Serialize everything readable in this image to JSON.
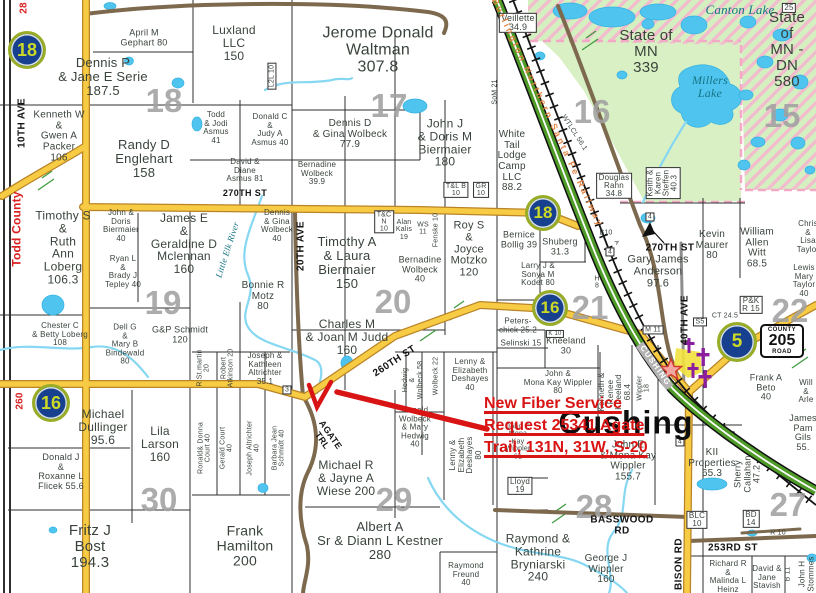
{
  "map": {
    "town_label": "Cushing",
    "county_road_sign": {
      "top": "COUNTY",
      "number": "205",
      "bottom": "ROAD",
      "x": 782,
      "y": 341
    },
    "annotation": {
      "color": "#d91414",
      "lines": [
        {
          "text": "New Fiber Service",
          "x": 484,
          "y": 395
        },
        {
          "text": "Request 25341 Agate",
          "x": 484,
          "y": 417
        },
        {
          "text": "Trail, 131N, 31W, S-20",
          "x": 484,
          "y": 439
        }
      ]
    },
    "highway_markers": [
      {
        "n": "18",
        "x": 27,
        "y": 50,
        "d": 32
      },
      {
        "n": "18",
        "x": 543,
        "y": 213,
        "d": 30
      },
      {
        "n": "16",
        "x": 550,
        "y": 308,
        "d": 30
      },
      {
        "n": "16",
        "x": 51,
        "y": 403,
        "d": 32
      },
      {
        "n": "5",
        "x": 737,
        "y": 342,
        "d": 34
      }
    ],
    "section_numbers": [
      {
        "n": "18",
        "x": 164,
        "y": 101
      },
      {
        "n": "17",
        "x": 389,
        "y": 106
      },
      {
        "n": "16",
        "x": 592,
        "y": 112
      },
      {
        "n": "15",
        "x": 782,
        "y": 116
      },
      {
        "n": "19",
        "x": 163,
        "y": 303
      },
      {
        "n": "20",
        "x": 393,
        "y": 302
      },
      {
        "n": "21",
        "x": 590,
        "y": 308
      },
      {
        "n": "22",
        "x": 790,
        "y": 311
      },
      {
        "n": "30",
        "x": 159,
        "y": 500
      },
      {
        "n": "29",
        "x": 394,
        "y": 500
      },
      {
        "n": "28",
        "x": 594,
        "y": 507
      },
      {
        "n": "27",
        "x": 788,
        "y": 505
      }
    ],
    "colors": {
      "road_yellow": "#f7cb43",
      "road_edge": "#b98427",
      "road_brown": "#7d6a4e",
      "highway_green": "#4e9b28",
      "water_fill": "#4fc4ee",
      "state_land": "#d9f0c4",
      "hatch_pink": "#f2bccd",
      "marker_blue": "#17418e",
      "marker_text": "#cdd927",
      "annotation_red": "#d91414",
      "section_gray": "#a1a1a1",
      "cemetery_purple": "#8b1f9e"
    },
    "labels": [
      {
        "t": "April M\nGephart 80",
        "x": 144,
        "y": 38,
        "fs": 9
      },
      {
        "t": "Luxland\nLLC\n150",
        "x": 234,
        "y": 43,
        "fs": 12
      },
      {
        "t": "Jerome Donald\nWaltman\n307.8",
        "x": 378,
        "y": 50,
        "fs": 16
      },
      {
        "t": "Dennis P\n& Jane E Serie\n187.5",
        "x": 103,
        "y": 77,
        "fs": 13
      },
      {
        "t": "Kenneth W\n&\nGwen A\nPacker\n106",
        "x": 59,
        "y": 137,
        "fs": 10
      },
      {
        "t": "Randy D\nEnglehart\n158",
        "x": 144,
        "y": 159,
        "fs": 13
      },
      {
        "t": "Todd\n& Jodi\nAsmus\n41",
        "x": 216,
        "y": 128,
        "fs": 8
      },
      {
        "t": "Donald C\n&\nJudy A\nAsmus 40",
        "x": 270,
        "y": 130,
        "fs": 8
      },
      {
        "t": "David &\nDiane\nAsmus 81",
        "x": 245,
        "y": 171,
        "fs": 8
      },
      {
        "t": "Bernadine\nWolbeck\n39.9",
        "x": 317,
        "y": 174,
        "fs": 8
      },
      {
        "t": "Dennis D\n& Gina Wolbeck\n77.9",
        "x": 350,
        "y": 135,
        "fs": 10
      },
      {
        "t": "John J\n& Doris M\nBiermaier\n180",
        "x": 445,
        "y": 143,
        "fs": 12
      },
      {
        "t": "White\nTail\nLodge\nCamp\nLLC\n88.2",
        "x": 512,
        "y": 162,
        "fs": 10
      },
      {
        "t": "Veillette\n34.9",
        "x": 518,
        "y": 23,
        "fs": 9,
        "c": "boxed"
      },
      {
        "t": "State of\nMN\n339",
        "x": 646,
        "y": 52,
        "fs": 15
      },
      {
        "t": "State of\nMN - DN\n580",
        "x": 787,
        "y": 50,
        "fs": 15
      },
      {
        "t": "Douglas\nRahn\n34.8",
        "x": 614,
        "y": 186,
        "fs": 8,
        "c": "boxed"
      },
      {
        "t": "Keith &\nKaren\nSteffen\n40.3",
        "x": 663,
        "y": 183,
        "fs": 8,
        "r": -90,
        "c": "boxed"
      },
      {
        "t": "Timothy S\n&\nRuth\nAnn\nLoberg\n106.3",
        "x": 63,
        "y": 248,
        "fs": 12
      },
      {
        "t": "John &\nDoris\nBiermaier\n40",
        "x": 121,
        "y": 226,
        "fs": 8
      },
      {
        "t": "Ryan L\n&\nBrady J\nTepley 40",
        "x": 123,
        "y": 272,
        "fs": 8
      },
      {
        "t": "James E\n&\nGeraldine D\nMclennan\n160",
        "x": 184,
        "y": 244,
        "fs": 12
      },
      {
        "t": "Dennis\n& Gina\nWolbeck\n40",
        "x": 277,
        "y": 226,
        "fs": 8
      },
      {
        "t": "Bonnie R\nMotz\n80",
        "x": 263,
        "y": 297,
        "fs": 10
      },
      {
        "t": "Timothy A\n& Laura\nBiermaier\n150",
        "x": 347,
        "y": 263,
        "fs": 13
      },
      {
        "t": "T&C\nN\n10",
        "x": 384,
        "y": 222,
        "fs": 7,
        "c": "boxed"
      },
      {
        "t": "Alan\nKalis\n19",
        "x": 404,
        "y": 230,
        "fs": 7
      },
      {
        "t": "WS\n11",
        "x": 423,
        "y": 229,
        "fs": 7
      },
      {
        "t": "Fenske 10",
        "x": 436,
        "y": 230,
        "fs": 7,
        "r": -90
      },
      {
        "t": "Bernadine\nWolbeck\n40",
        "x": 420,
        "y": 270,
        "fs": 9
      },
      {
        "t": "Roy S\n&\nJoyce\nMotzko\n120",
        "x": 469,
        "y": 250,
        "fs": 11
      },
      {
        "t": "Bernice\nBollig 39",
        "x": 519,
        "y": 240,
        "fs": 9
      },
      {
        "t": "Shuberg\n31.3",
        "x": 560,
        "y": 247,
        "fs": 9
      },
      {
        "t": "Larry J &\nSonya M\nKodet 80",
        "x": 538,
        "y": 275,
        "fs": 8
      },
      {
        "t": "Chester C\n& Betty Loberg\n108",
        "x": 60,
        "y": 335,
        "fs": 8
      },
      {
        "t": "Dell G\n&\nMary B\nBindewald\n80",
        "x": 125,
        "y": 345,
        "fs": 8
      },
      {
        "t": "G&P Schmidt\n120",
        "x": 180,
        "y": 335,
        "fs": 9
      },
      {
        "t": "Charles M\n& Joan M Judd\n160",
        "x": 347,
        "y": 337,
        "fs": 12
      },
      {
        "t": "Peters-\nchick 25.2",
        "x": 518,
        "y": 326,
        "fs": 8
      },
      {
        "t": "Selinski 15",
        "x": 521,
        "y": 344,
        "fs": 8
      },
      {
        "t": "K 10",
        "x": 555,
        "y": 334,
        "fs": 6,
        "c": "boxed"
      },
      {
        "t": "Kneeland\n30",
        "x": 566,
        "y": 346,
        "fs": 9
      },
      {
        "t": "Kevin\nMaurer\n80",
        "x": 712,
        "y": 246,
        "fs": 10
      },
      {
        "t": "William\nAllen\nWitt\n68.5",
        "x": 757,
        "y": 249,
        "fs": 10
      },
      {
        "t": "Gary James\nAnderson\n97.6",
        "x": 658,
        "y": 272,
        "fs": 11
      },
      {
        "t": "Lewis\nMary\nTaylor\n40",
        "x": 804,
        "y": 281,
        "fs": 8
      },
      {
        "t": "Chris &\nLisa\nTaylor",
        "x": 808,
        "y": 237,
        "fs": 8
      },
      {
        "t": "P&K\nR 15",
        "x": 751,
        "y": 305,
        "fs": 8,
        "c": "boxed"
      },
      {
        "t": "CT 24.5",
        "x": 725,
        "y": 316,
        "fs": 7
      },
      {
        "t": "S5",
        "x": 700,
        "y": 322,
        "fs": 7,
        "c": "boxed"
      },
      {
        "t": "M 11",
        "x": 653,
        "y": 330,
        "fs": 7,
        "c": "boxed"
      },
      {
        "t": "H\n8",
        "x": 597,
        "y": 283,
        "fs": 7
      },
      {
        "t": "B10",
        "x": 606,
        "y": 233,
        "fs": 7
      },
      {
        "t": "A",
        "x": 616,
        "y": 243,
        "fs": 6,
        "r": 55
      },
      {
        "t": "4",
        "x": 610,
        "y": 252,
        "fs": 7,
        "c": "boxed"
      },
      {
        "t": "4",
        "x": 650,
        "y": 217,
        "fs": 7,
        "c": "boxed"
      },
      {
        "t": "4",
        "x": 680,
        "y": 442,
        "fs": 7,
        "c": "boxed"
      },
      {
        "t": "270TH ST",
        "x": 245,
        "y": 194,
        "fs": 9,
        "c": "road"
      },
      {
        "t": "270TH ST",
        "x": 670,
        "y": 249,
        "fs": 10,
        "c": "road"
      },
      {
        "t": "260TH ST",
        "x": 395,
        "y": 362,
        "fs": 10,
        "c": "road",
        "r": -33
      },
      {
        "t": "AGATE\nTRL",
        "x": 326,
        "y": 438,
        "fs": 9,
        "c": "road",
        "r": 55
      },
      {
        "t": "BASSWOOD\nRD",
        "x": 622,
        "y": 526,
        "fs": 10,
        "c": "road"
      },
      {
        "t": "253RD ST",
        "x": 733,
        "y": 549,
        "fs": 10,
        "c": "road"
      },
      {
        "t": "BISON RD",
        "x": 680,
        "y": 564,
        "fs": 10,
        "c": "road",
        "r": -90
      },
      {
        "t": "40TH AVE",
        "x": 686,
        "y": 320,
        "fs": 10,
        "c": "road",
        "r": -90
      },
      {
        "t": "20TH AVE",
        "x": 302,
        "y": 246,
        "fs": 10,
        "c": "road",
        "r": -90
      },
      {
        "t": "10TH AVE",
        "x": 23,
        "y": 123,
        "fs": 10,
        "c": "road",
        "r": -90
      },
      {
        "t": "SoM 21",
        "x": 495,
        "y": 92,
        "fs": 7,
        "r": -90
      },
      {
        "t": "WTLCL 56.1",
        "x": 574,
        "y": 133,
        "fs": 7,
        "r": 57
      },
      {
        "t": "L2L 10",
        "x": 272,
        "y": 76,
        "fs": 7,
        "r": -90,
        "c": "boxed"
      },
      {
        "t": "T&L B\n10",
        "x": 456,
        "y": 190,
        "fs": 7,
        "c": "boxed"
      },
      {
        "t": "GR\n10",
        "x": 481,
        "y": 190,
        "fs": 7,
        "c": "boxed"
      },
      {
        "t": "Burlington Northern Santa Fe Railway",
        "x": 547,
        "y": 113,
        "fs": 9,
        "c": "rail",
        "r": 65
      },
      {
        "t": "Todd County",
        "x": 17,
        "y": 229,
        "fs": 12,
        "c": "red",
        "r": -90
      },
      {
        "t": "28",
        "x": 25,
        "y": 8,
        "fs": 10,
        "c": "red",
        "r": -90
      },
      {
        "t": "260",
        "x": 21,
        "y": 401,
        "fs": 10,
        "c": "red",
        "r": -90
      },
      {
        "t": "Canton Lake",
        "x": 740,
        "y": 10,
        "fs": 13,
        "c": "water"
      },
      {
        "t": "Millers\nLake",
        "x": 710,
        "y": 87,
        "fs": 12,
        "c": "water"
      },
      {
        "t": "Little Elk River",
        "x": 228,
        "y": 250,
        "fs": 9,
        "c": "water",
        "r": -72
      },
      {
        "t": "Michael\nDullinger\n95.6",
        "x": 103,
        "y": 427,
        "fs": 12
      },
      {
        "t": "Lila\nLarson\n160",
        "x": 160,
        "y": 444,
        "fs": 12
      },
      {
        "t": "Donald J\n&\nRoxanne L\nFlicek 55.6",
        "x": 61,
        "y": 472,
        "fs": 9
      },
      {
        "t": "Fritz J\nBost\n194.3",
        "x": 90,
        "y": 547,
        "fs": 15
      },
      {
        "t": "Frank\nHamilton\n200",
        "x": 245,
        "y": 546,
        "fs": 14
      },
      {
        "t": "R St.martin\n20",
        "x": 204,
        "y": 368,
        "fs": 7,
        "r": -90
      },
      {
        "t": "Robert\nAtkinson 20",
        "x": 228,
        "y": 368,
        "fs": 7,
        "r": -90
      },
      {
        "t": "Joseph &\nKathleen\nAltrichter\n35.1",
        "x": 265,
        "y": 369,
        "fs": 8
      },
      {
        "t": "3",
        "x": 287,
        "y": 390,
        "fs": 7,
        "c": "boxed"
      },
      {
        "t": "Ronald& Donna\nCourt 40",
        "x": 205,
        "y": 448,
        "fs": 7,
        "r": -90
      },
      {
        "t": "Gerald Court\n40",
        "x": 227,
        "y": 448,
        "fs": 7,
        "r": -90
      },
      {
        "t": "Joseph Altrichter\n40",
        "x": 254,
        "y": 448,
        "fs": 7,
        "r": -90
      },
      {
        "t": "Barbara Jean\nSchmidt 40",
        "x": 279,
        "y": 448,
        "fs": 7,
        "r": -90
      },
      {
        "t": "Michael R\n& Jayne A\nWiese 200",
        "x": 346,
        "y": 478,
        "fs": 12
      },
      {
        "t": "Albert A\nSr & Diann L Kestner\n280",
        "x": 380,
        "y": 541,
        "fs": 13
      },
      {
        "t": "Raymond\nFreund\n40",
        "x": 466,
        "y": 575,
        "fs": 8
      },
      {
        "t": "Raymond &\nKathrine\nBryniarski\n240",
        "x": 538,
        "y": 558,
        "fs": 12
      },
      {
        "t": "Hedwig\n&\nWolbeck 58",
        "x": 413,
        "y": 380,
        "fs": 7,
        "r": -90
      },
      {
        "t": "Wolbeck 22",
        "x": 436,
        "y": 376,
        "fs": 7,
        "r": -90
      },
      {
        "t": "Lenny &\nElizabeth\nDeshayes\n40",
        "x": 470,
        "y": 375,
        "fs": 8
      },
      {
        "t": "Donald\nWolbeck\n& Mary\nHedwig\n40",
        "x": 415,
        "y": 428,
        "fs": 8
      },
      {
        "t": "Lenny &\nElizabeth\nDeshayes\n80",
        "x": 466,
        "y": 455,
        "fs": 8,
        "r": -90
      },
      {
        "t": "John E\nMona\nKay\nWippler\n61",
        "x": 518,
        "y": 442,
        "fs": 7
      },
      {
        "t": "Lloyd\n19",
        "x": 520,
        "y": 486,
        "fs": 8,
        "c": "boxed"
      },
      {
        "t": "John &\nMona Kay Wippler\n80",
        "x": 558,
        "y": 383,
        "fs": 8
      },
      {
        "t": "Kenneth &\nRenee\nKneeland\n68.4",
        "x": 615,
        "y": 392,
        "fs": 8,
        "r": -90
      },
      {
        "t": "Wippler\n18",
        "x": 644,
        "y": 388,
        "fs": 7,
        "r": -90
      },
      {
        "t": "John E\n& Mona Kay\nWippler\n155.7",
        "x": 628,
        "y": 462,
        "fs": 10
      },
      {
        "t": "KII\nProperties\n65.3",
        "x": 712,
        "y": 464,
        "fs": 10
      },
      {
        "t": "Sherry\nCallahan\n47.2",
        "x": 748,
        "y": 474,
        "fs": 9,
        "r": -90
      },
      {
        "t": "Frank A\nBeto\n40",
        "x": 766,
        "y": 388,
        "fs": 9
      },
      {
        "t": "Will\n& Arle",
        "x": 806,
        "y": 392,
        "fs": 8
      },
      {
        "t": "James\nPam\nGils\n55.",
        "x": 803,
        "y": 433,
        "fs": 9
      },
      {
        "t": "George J\nWippler\n160",
        "x": 606,
        "y": 570,
        "fs": 10
      },
      {
        "t": "Richard R\n&\nMalinda L\nHeinz",
        "x": 728,
        "y": 577,
        "fs": 8
      },
      {
        "t": "David &\nJane\nStavish",
        "x": 767,
        "y": 578,
        "fs": 8
      },
      {
        "t": "B 11",
        "x": 788,
        "y": 574,
        "fs": 7,
        "r": -90
      },
      {
        "t": "John H\nStommes",
        "x": 807,
        "y": 574,
        "fs": 8,
        "r": -90
      },
      {
        "t": "BLC\n10",
        "x": 697,
        "y": 520,
        "fs": 8,
        "c": "boxed"
      },
      {
        "t": "BD\n14",
        "x": 751,
        "y": 519,
        "fs": 8,
        "c": "boxed"
      },
      {
        "t": "R 10",
        "x": 778,
        "y": 533,
        "fs": 7
      },
      {
        "t": "25",
        "x": 789,
        "y": 8,
        "fs": 8,
        "c": "boxed"
      },
      {
        "t": "CUSHING",
        "x": 655,
        "y": 366,
        "fs": 8,
        "c": "band",
        "r": 55
      }
    ]
  }
}
